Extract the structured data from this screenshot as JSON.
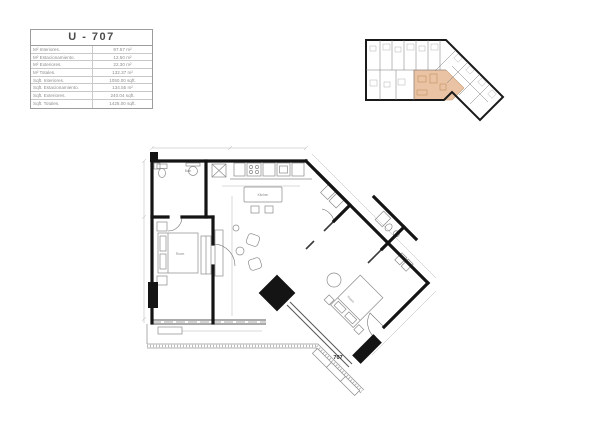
{
  "unit_table": {
    "title": "U - 707",
    "rows": [
      {
        "label": "M² Interiores.",
        "value": "97.57 m²"
      },
      {
        "label": "M² Estacionamiento.",
        "value": "12.50 m²"
      },
      {
        "label": "M² Exteriores.",
        "value": "22.30 m²"
      },
      {
        "label": "M² Totales.",
        "value": "132.37 m²"
      },
      {
        "label": "Sqft. Interiores.",
        "value": "1050.00 sqft."
      },
      {
        "label": "Sqft. Estacionamiento.",
        "value": "134.55 m²"
      },
      {
        "label": "Sqft. Exteriores.",
        "value": "240.04 sqft."
      },
      {
        "label": "Sqft. Totales.",
        "value": "1425.00 sqft."
      }
    ]
  },
  "floor_plan": {
    "unit_number": "707",
    "labels": {
      "kitchen": "Kitchen",
      "bath": "Bath",
      "bedroom1": "Room",
      "bedroom2": "Room"
    }
  },
  "key_plan": {
    "description": "building key plan with unit 707 highlighted"
  },
  "colors": {
    "highlight": "#e9c3a3",
    "wall": "#141414",
    "furniture": "#8c8c8c",
    "dimension": "#b4b4b4",
    "table_border": "#9d9d9d",
    "table_text": "#8f8f8f",
    "title_text": "#4c4c4c"
  }
}
